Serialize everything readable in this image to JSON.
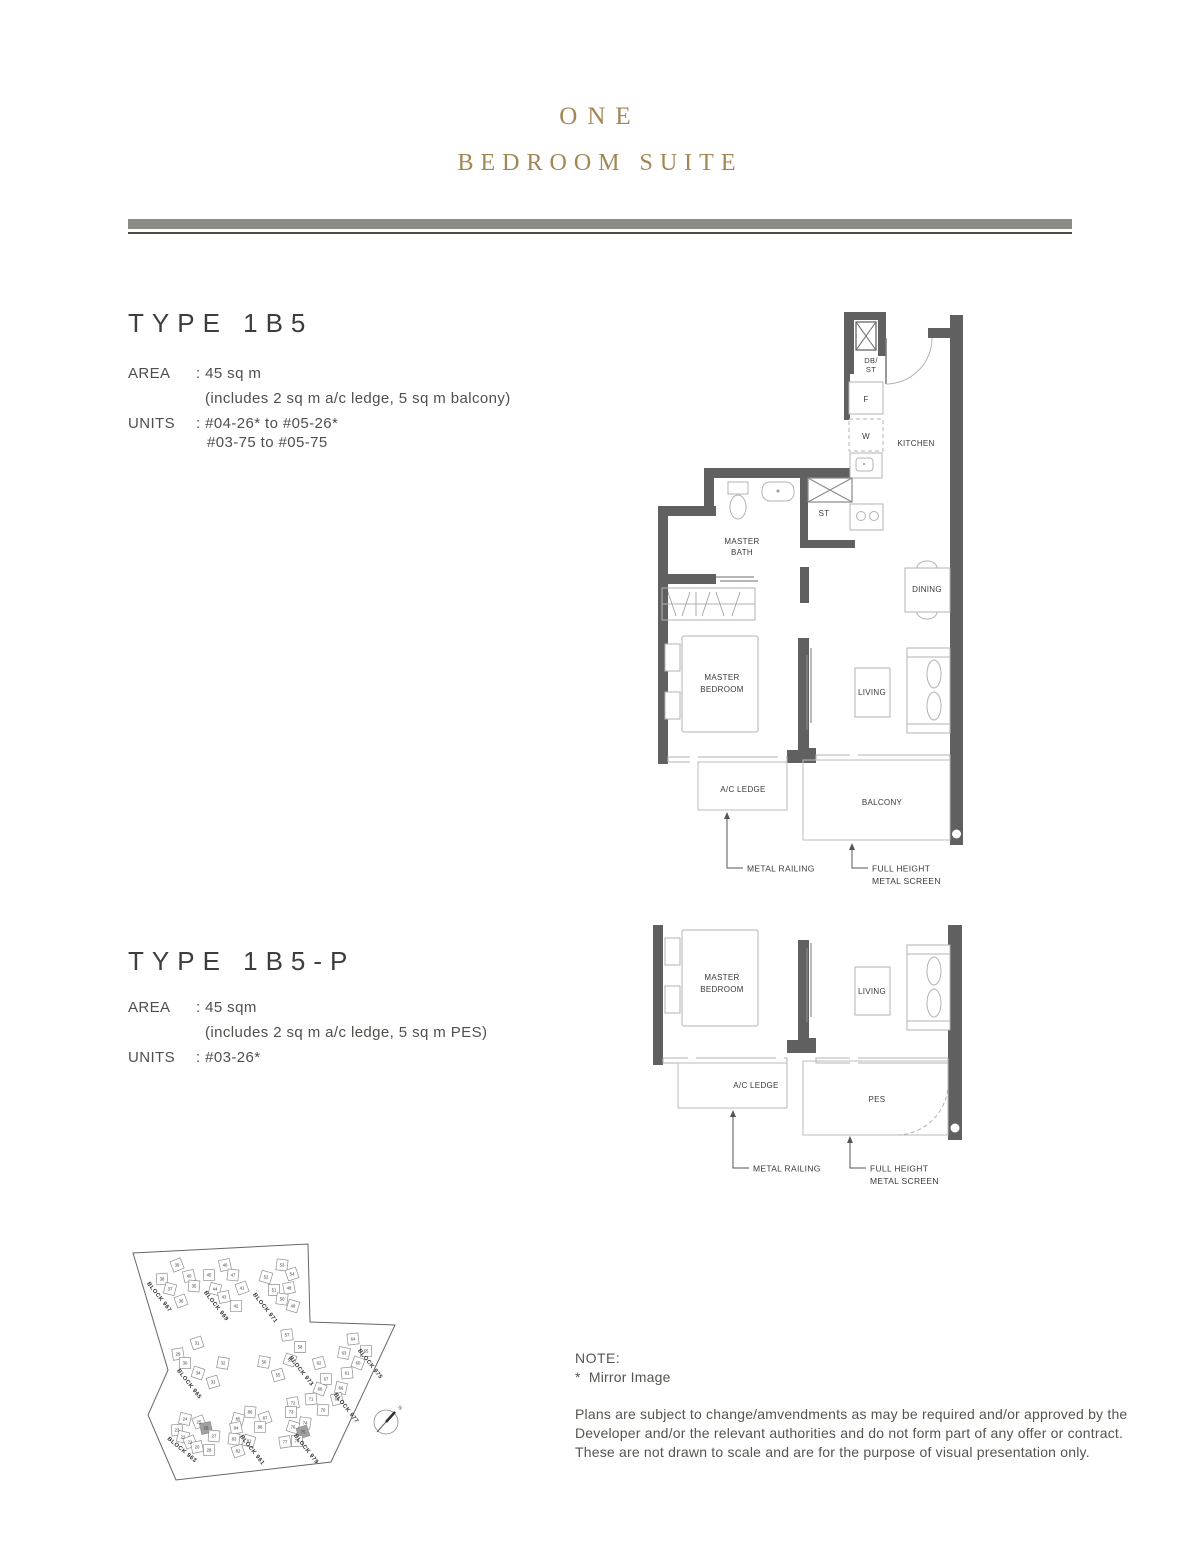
{
  "header": {
    "title_line1": "ONE",
    "title_line2": "BEDROOM SUITE"
  },
  "colors": {
    "title_gold": "#a28754",
    "divider_bar": "#8c8c87",
    "divider_line": "#4d4d48",
    "wall_gray": "#606060",
    "highlight_unit": "#a0a0a0"
  },
  "type_1b5": {
    "name": "TYPE 1B5",
    "area_label": "AREA",
    "area_value": ": 45 sq m",
    "area_note": "(includes 2 sq m a/c ledge, 5 sq m balcony)",
    "units_label": "UNITS",
    "units_line1": ": #04-26* to #05-26*",
    "units_line2": "#03-75 to #05-75"
  },
  "type_1b5p": {
    "name": "TYPE 1B5-P",
    "area_label": "AREA",
    "area_value": ": 45 sqm",
    "area_note": "(includes 2 sq m a/c ledge, 5 sq m PES)",
    "units_label": "UNITS",
    "units_line1": ": #03-26*"
  },
  "plan_1b5": {
    "db1": "DB/",
    "db2": "ST",
    "fridge": "F",
    "washer": "W",
    "store": "ST",
    "kitchen": "KITCHEN",
    "master_bath_1": "MASTER",
    "master_bath_2": "BATH",
    "dining": "DINING",
    "master_bedroom_1": "MASTER",
    "master_bedroom_2": "BEDROOM",
    "living": "LIVING",
    "ac_ledge": "A/C LEDGE",
    "balcony": "BALCONY",
    "metal_railing": "METAL RAILING",
    "full_height_1": "FULL HEIGHT",
    "full_height_2": "METAL SCREEN"
  },
  "plan_1b5p": {
    "master_bedroom_1": "MASTER",
    "master_bedroom_2": "BEDROOM",
    "living": "LIVING",
    "ac_ledge": "A/C LEDGE",
    "pes": "PES",
    "metal_railing": "METAL RAILING",
    "full_height_1": "FULL HEIGHT",
    "full_height_2": "METAL SCREEN"
  },
  "site_plan": {
    "compass": "N",
    "blocks": [
      {
        "label": "BLOCK 967",
        "x": 40,
        "y": 66,
        "angle": 52
      },
      {
        "label": "BLOCK 969",
        "x": 97,
        "y": 75,
        "angle": 52
      },
      {
        "label": "BLOCK 971",
        "x": 146,
        "y": 77,
        "angle": 52
      },
      {
        "label": "BLOCK 965",
        "x": 70,
        "y": 153,
        "angle": 52
      },
      {
        "label": "BLOCK 973",
        "x": 182,
        "y": 140,
        "angle": 52
      },
      {
        "label": "BLOCK 975",
        "x": 251,
        "y": 133,
        "angle": 52
      },
      {
        "label": "BLOCK 977",
        "x": 227,
        "y": 177,
        "angle": 52
      },
      {
        "label": "BLOCK 963",
        "x": 63,
        "y": 219,
        "angle": 40
      },
      {
        "label": "BLOCK 961",
        "x": 133,
        "y": 219,
        "angle": 52
      },
      {
        "label": "BLOCK 979",
        "x": 187,
        "y": 218,
        "angle": 52
      }
    ],
    "units": [
      {
        "n": "39",
        "x": 59,
        "y": 33
      },
      {
        "n": "40",
        "x": 71,
        "y": 44
      },
      {
        "n": "38",
        "x": 44,
        "y": 47
      },
      {
        "n": "35",
        "x": 76,
        "y": 54
      },
      {
        "n": "37",
        "x": 52,
        "y": 57
      },
      {
        "n": "36",
        "x": 63,
        "y": 69
      },
      {
        "n": "46",
        "x": 107,
        "y": 33
      },
      {
        "n": "45",
        "x": 91,
        "y": 43
      },
      {
        "n": "47",
        "x": 115,
        "y": 43
      },
      {
        "n": "44",
        "x": 97,
        "y": 57
      },
      {
        "n": "41",
        "x": 124,
        "y": 56
      },
      {
        "n": "43",
        "x": 106,
        "y": 65
      },
      {
        "n": "42",
        "x": 118,
        "y": 74
      },
      {
        "n": "53",
        "x": 164,
        "y": 33
      },
      {
        "n": "52",
        "x": 148,
        "y": 45
      },
      {
        "n": "54",
        "x": 174,
        "y": 42
      },
      {
        "n": "48",
        "x": 171,
        "y": 56
      },
      {
        "n": "51",
        "x": 156,
        "y": 58
      },
      {
        "n": "50",
        "x": 164,
        "y": 67
      },
      {
        "n": "49",
        "x": 175,
        "y": 74
      },
      {
        "n": "31",
        "x": 79,
        "y": 111
      },
      {
        "n": "29",
        "x": 60,
        "y": 122
      },
      {
        "n": "30",
        "x": 67,
        "y": 131
      },
      {
        "n": "32",
        "x": 105,
        "y": 131
      },
      {
        "n": "34",
        "x": 80,
        "y": 141
      },
      {
        "n": "33",
        "x": 95,
        "y": 150
      },
      {
        "n": "57",
        "x": 169,
        "y": 103
      },
      {
        "n": "58",
        "x": 182,
        "y": 115
      },
      {
        "n": "56",
        "x": 146,
        "y": 130
      },
      {
        "n": "59",
        "x": 172,
        "y": 128
      },
      {
        "n": "55",
        "x": 160,
        "y": 143
      },
      {
        "n": "64",
        "x": 235,
        "y": 107
      },
      {
        "n": "65",
        "x": 248,
        "y": 119
      },
      {
        "n": "63",
        "x": 226,
        "y": 121
      },
      {
        "n": "60",
        "x": 240,
        "y": 131
      },
      {
        "n": "62",
        "x": 201,
        "y": 131
      },
      {
        "n": "61",
        "x": 229,
        "y": 141
      },
      {
        "n": "67",
        "x": 208,
        "y": 147
      },
      {
        "n": "66",
        "x": 223,
        "y": 156
      },
      {
        "n": "68",
        "x": 202,
        "y": 157
      },
      {
        "n": "69",
        "x": 219,
        "y": 167
      },
      {
        "n": "71",
        "x": 193,
        "y": 167
      },
      {
        "n": "70",
        "x": 205,
        "y": 178
      },
      {
        "n": "24",
        "x": 67,
        "y": 187
      },
      {
        "n": "25",
        "x": 81,
        "y": 190
      },
      {
        "n": "26",
        "x": 88,
        "y": 196,
        "hl": true
      },
      {
        "n": "23",
        "x": 59,
        "y": 198
      },
      {
        "n": "27",
        "x": 96,
        "y": 204
      },
      {
        "n": "22",
        "x": 65,
        "y": 205
      },
      {
        "n": "21",
        "x": 72,
        "y": 210
      },
      {
        "n": "20",
        "x": 79,
        "y": 215
      },
      {
        "n": "28",
        "x": 91,
        "y": 218
      },
      {
        "n": "86",
        "x": 132,
        "y": 180
      },
      {
        "n": "85",
        "x": 120,
        "y": 187
      },
      {
        "n": "87",
        "x": 147,
        "y": 186
      },
      {
        "n": "84",
        "x": 118,
        "y": 196
      },
      {
        "n": "88",
        "x": 142,
        "y": 195
      },
      {
        "n": "83",
        "x": 116,
        "y": 207
      },
      {
        "n": "81",
        "x": 131,
        "y": 209
      },
      {
        "n": "82",
        "x": 120,
        "y": 219
      },
      {
        "n": "72",
        "x": 175,
        "y": 171
      },
      {
        "n": "73",
        "x": 173,
        "y": 180
      },
      {
        "n": "74",
        "x": 187,
        "y": 191
      },
      {
        "n": "76",
        "x": 175,
        "y": 195
      },
      {
        "n": "75",
        "x": 185,
        "y": 200,
        "hl": true
      },
      {
        "n": "77",
        "x": 167,
        "y": 210
      },
      {
        "n": "78",
        "x": 179,
        "y": 209
      }
    ]
  },
  "note": {
    "heading": "NOTE:",
    "asterisk": "*",
    "mirror": "Mirror Image",
    "line1": "Plans are subject to change/amvendments as may be required and/or approved by the",
    "line2": "Developer and/or the relevant authorities and do not form part of any offer or contract.",
    "line3": "These are not drawn to scale and are for the purpose of visual presentation only."
  }
}
